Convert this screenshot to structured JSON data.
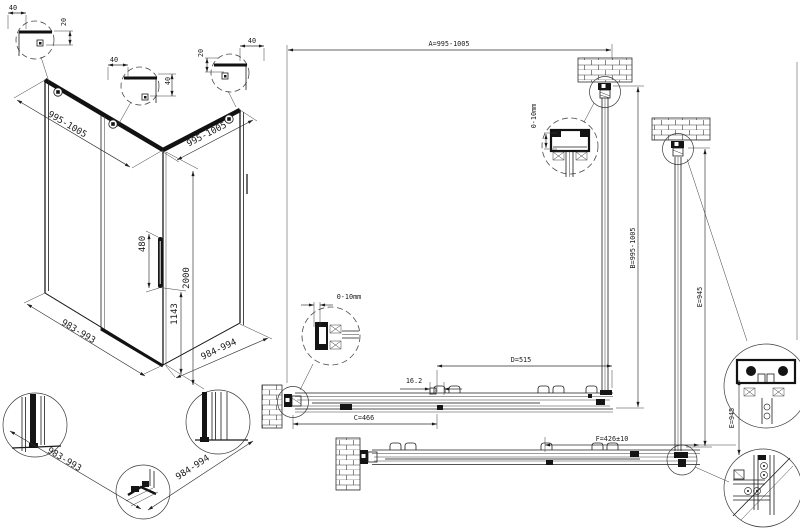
{
  "iso": {
    "detail_left": {
      "w": "40",
      "h": "20"
    },
    "detail_mid": {
      "w": "40",
      "h": "40"
    },
    "detail_right": {
      "w": "40",
      "h": "20"
    },
    "top_left": "995-1005",
    "top_right": "995-1005",
    "handle_len": "480",
    "height": "2000",
    "handle_pos": "1143",
    "base_front": "983-993",
    "base_side": "984-994"
  },
  "base_details": {
    "front": "983-993",
    "side": "984-994"
  },
  "plan": {
    "a": "A=995-1005",
    "b": "B=995-1005",
    "c": "C=466",
    "d": "D=515",
    "e_side": "E=945",
    "e_inner": "E=945",
    "f": "F=426±10",
    "gap": "16.2",
    "adjust_top": "0-10mm",
    "adjust_left": "0-10mm"
  }
}
